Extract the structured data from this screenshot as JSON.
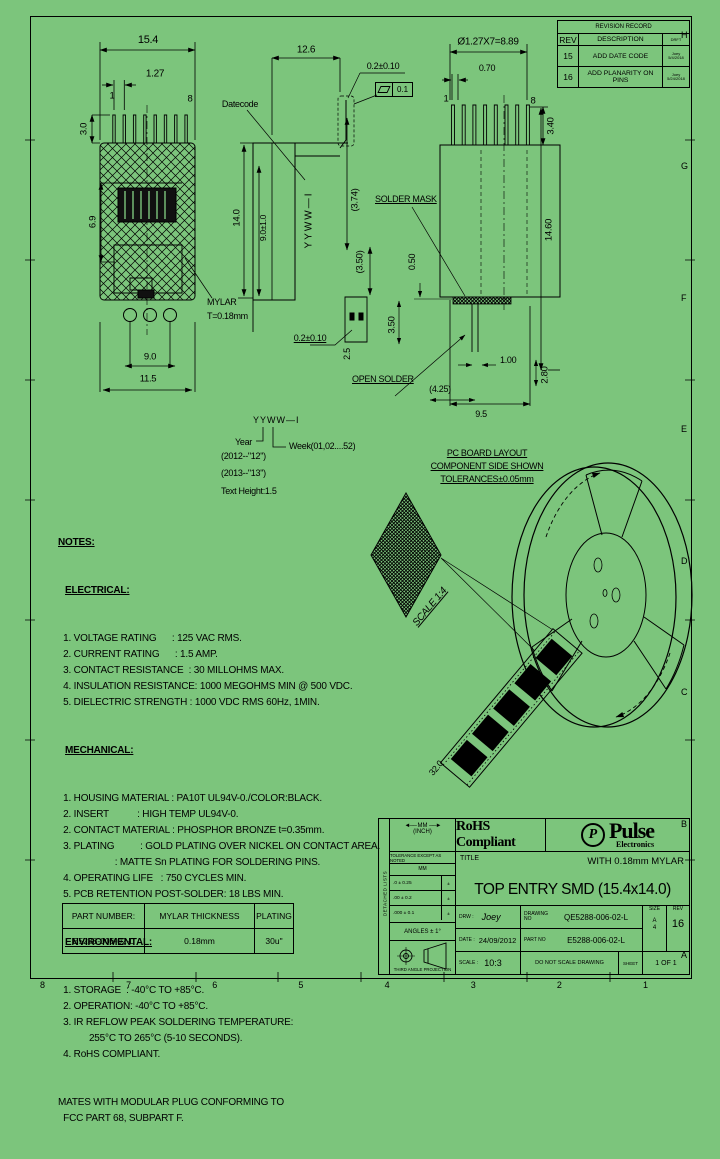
{
  "meta": {
    "bg": "#7CC57C",
    "ink": "#000000"
  },
  "zones": {
    "bottom": [
      "8",
      "7",
      "6",
      "5",
      "4",
      "3",
      "2",
      "1"
    ],
    "right": [
      "H",
      "G",
      "F",
      "E",
      "D",
      "C",
      "B",
      "A"
    ]
  },
  "revision_table": {
    "title": "REVISION RECORD",
    "headers": [
      "REV",
      "DESCRIPTION",
      "DRFT"
    ],
    "rows": [
      {
        "rev": "15",
        "desc": "ADD DATE CODE",
        "by": [
          "Joey",
          "5/4/2018"
        ]
      },
      {
        "rev": "16",
        "desc": "ADD PLANARITY ON PINS",
        "by": [
          "Joey",
          "5/24/2018"
        ]
      }
    ]
  },
  "front_view": {
    "width": "15.4",
    "pitch": "1.27",
    "pin1": "1",
    "pin8": "8",
    "pin_height": "3.0",
    "cavity": "6.9",
    "holes": "9.0",
    "overall": "11.5",
    "datecode": "Datecode",
    "mylar1": "MYLAR",
    "mylar2": "T=0.18mm"
  },
  "side_view": {
    "depth": "12.6",
    "coplan": "0.2±0.10",
    "flatness": "0.1",
    "d374": "(3.74)",
    "height": "14.0",
    "d9010": "9.0±1.0",
    "marking": "YYWW—I",
    "d350": "(3.50)",
    "coplan2": "0.2±0.10",
    "d25": "2.5"
  },
  "rear_view": {
    "span": "Ø1.27X7=8.89",
    "pinw": "0.70",
    "pin1": "1",
    "pin8": "8",
    "d340": "3.40",
    "mask": "SOLDER MASK",
    "d050": "0.50",
    "d1460": "14.60",
    "d350": "3.50",
    "d100": "1.00",
    "d425": "(4.25)",
    "d280": "2.80",
    "d95": "9.5",
    "open": "OPEN SOLDER"
  },
  "datecode_legend": {
    "code": "YYWW—I",
    "year": "Year",
    "week": "Week(01,02....52)",
    "ex1": "(2012--\"12\")",
    "ex2": "(2013--\"13\")",
    "height": "Text Height:1.5"
  },
  "pcb_note": {
    "l1": "PC BOARD LAYOUT",
    "l2": "COMPONENT SIDE SHOWN",
    "l3": "TOLERANCES±0.05mm"
  },
  "reel": {
    "scale": "SCALE 1:4",
    "pitch": "20.0",
    "width": "32.0"
  },
  "notes": {
    "title": "NOTES:",
    "electrical_title": "ELECTRICAL:",
    "electrical": [
      "  1. VOLTAGE RATING      : 125 VAC RMS.",
      "  2. CURRENT RATING      : 1.5 AMP.",
      "  3. CONTACT RESISTANCE  : 30 MILLOHMS MAX.",
      "  4. INSULATION RESISTANCE: 1000 MEGOHMS MIN @ 500 VDC.",
      "  5. DIELECTRIC STRENGTH : 1000 VDC RMS 60Hz, 1MIN."
    ],
    "mechanical_title": "MECHANICAL:",
    "mechanical": [
      "  1. HOUSING MATERIAL : PA10T UL94V-0./COLOR:BLACK.",
      "  2. INSERT           : HIGH TEMP UL94V-0.",
      "  2. CONTACT MATERIAL : PHOSPHOR BRONZE t=0.35mm.",
      "  3. PLATING          : GOLD PLATING OVER NICKEL ON CONTACT AREA.",
      "                      : MATTE Sn PLATING FOR SOLDERING PINS.",
      "  4. OPERATING LIFE   : 750 CYCLES MIN.",
      "  5. PCB RETENTION POST-SOLDER: 18 LBS MIN."
    ],
    "environmental_title": "ENVIRONMENTAL:",
    "environmental": [
      "  1. STORAGE  : -40°C TO +85°C.",
      "  2. OPERATION: -40°C TO +85°C.",
      "  3. IR REFLOW PEAK SOLDERING TEMPERATURE:",
      "            255°C TO 265°C (5-10 SECONDS).",
      "  4. RoHS COMPLIANT."
    ],
    "footer": [
      "MATES WITH MODULAR PLUG CONFORMING TO",
      "  FCC PART 68, SUBPART F."
    ]
  },
  "part_table": {
    "headers": [
      "PART NUMBER:",
      "MYLAR THICKNESS",
      "PLATING"
    ],
    "row": [
      "E5288-006-02-L",
      "0.18mm",
      "30u\""
    ]
  },
  "title_block": {
    "side_label": "DETACHED LISTS",
    "units_top": "MM",
    "units_bottom": "(INCH)",
    "tol_note": "TOLERANCE EXCEPT AS NOTED",
    "tol_head": "MM",
    "tol_rows": [
      {
        "mm": ".0   ± 0.25",
        "in": "±"
      },
      {
        "mm": ".00  ± 0.2",
        "in": "±"
      },
      {
        "mm": ".000 ± 0.1",
        "in": "±"
      }
    ],
    "angles": "ANGLES ± 1°",
    "projection": "THIRD ANGLE PROJECTION",
    "rohs": "RoHS Compliant",
    "logo_p": "P",
    "brand": "Pulse",
    "brand_sub": "Electronics",
    "title_label": "TITLE",
    "subtitle": "WITH 0.18mm MYLAR",
    "title": "TOP ENTRY SMD (15.4x14.0)",
    "drw_label": "DRW :",
    "drw": "Joey",
    "date_label": "DATE :",
    "date": "24/09/2012",
    "scale_label": "SCALE :",
    "scale": "10:3",
    "dwgno_label": "DRAWING NO",
    "dwgno": "QE5288-006-02-L",
    "partno_label": "PART NO",
    "partno": "E5288-006-02-L",
    "size_label": "SIZE",
    "size": [
      "A",
      "4"
    ],
    "rev_label": "REV",
    "rev": "16",
    "noscale": "DO NOT SCALE DRAWING",
    "sheet_label": "SHEET",
    "sheet": "1 OF 1"
  }
}
